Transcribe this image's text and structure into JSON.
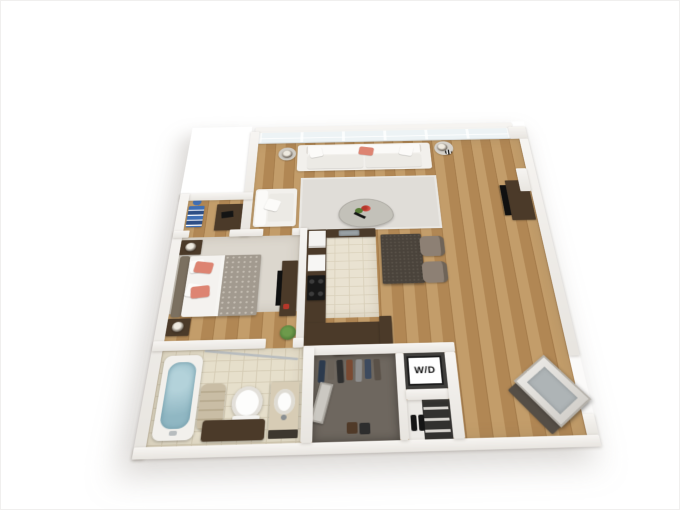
{
  "meta": {
    "type": "3d-floor-plan-rendering",
    "view": "top-down-perspective",
    "background": "#ffffff"
  },
  "labels": {
    "washer_dryer": "W/D"
  },
  "colors": {
    "wall": "#f7f5f2",
    "wall_shade": "#e8e5e0",
    "wood": "#c39d6a",
    "wood_dark": "#b18754",
    "tile": "#e9e2d1",
    "grout": "#d9d0ba",
    "bath_tile": "#e6dfcb",
    "carpet": "#dcd7ce",
    "rug": "#e0ddd8",
    "closet_floor": "#6e675f",
    "dark_wood": "#4b3a29",
    "granite": "#4a433b",
    "sofa_white": "#f2f0ec",
    "coral": "#dd8472",
    "taupe_chair": "#8d8074",
    "water": "#90b7c3",
    "plant": "#4e7a36",
    "glass": "#edf3f5",
    "blue_decor": "#3f6fb5",
    "red_accent": "#b5372a",
    "towel": "#c9bda5",
    "mat_dark": "#554e46",
    "door_gray": "#aeb4b6"
  },
  "rooms": [
    {
      "name": "living-room",
      "floor": "hardwood",
      "furniture": [
        "window-wall",
        "white-sofa",
        "coral-throw-pillow",
        "side-tables-with-lamps",
        "armchair",
        "area-rug",
        "glass-coffee-table",
        "flowers",
        "tv-stand",
        "flat-tv"
      ]
    },
    {
      "name": "kitchen",
      "floor": "tile",
      "furniture": [
        "l-shaped-dark-counter",
        "refrigerator",
        "wall-oven",
        "black-cooktop",
        "steel-sink",
        "granite-island",
        "two-upholstered-stools"
      ]
    },
    {
      "name": "bedroom",
      "floor": "carpet",
      "furniture": [
        "bed-with-coral-pillows",
        "patterned-duvet",
        "headboard",
        "two-nightstands-with-lamps",
        "four-wall-frames",
        "dresser-with-tv",
        "potted-plant",
        "desk-nook-with-blue-books"
      ]
    },
    {
      "name": "bathroom",
      "floor": "tile",
      "furniture": [
        "bathtub-with-water",
        "shower-rod",
        "rolled-towels",
        "toilet",
        "vanity-with-round-sink",
        "dark-storage-bench"
      ]
    },
    {
      "name": "walk-in-closet",
      "floor": "dark-carpet",
      "furniture": [
        "hanging-clothes",
        "leaning-mirror",
        "shoes",
        "storage-bag"
      ]
    },
    {
      "name": "laundry-closet",
      "furniture": [
        "stacked-washer-dryer"
      ]
    },
    {
      "name": "linen-closet",
      "furniture": [
        "shelves",
        "boots"
      ]
    },
    {
      "name": "entry",
      "floor": "hardwood",
      "furniture": [
        "open-door-leaf",
        "dark-doormat"
      ]
    }
  ]
}
